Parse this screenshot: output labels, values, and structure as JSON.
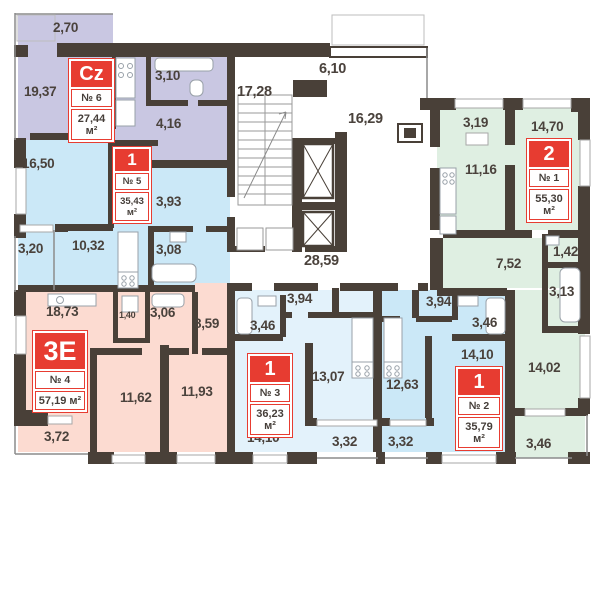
{
  "colors": {
    "wall": "#494038",
    "accent_red": "#e73c31",
    "apt6_fill": "#c9c7e2",
    "apt5_fill": "#cbe8f7",
    "apt4_fill": "#fcdbd1",
    "apt3_fill": "#e3f2fb",
    "apt2_fill": "#cbe8f7",
    "apt1_fill": "#dfefe2"
  },
  "apartments": [
    {
      "key": "apt6",
      "type_label": "Cz",
      "number": "№ 6",
      "area": "27,44 м²",
      "rooms": [
        {
          "name": "balcony",
          "dim": "2,70"
        },
        {
          "name": "living",
          "dim": "19,37"
        },
        {
          "name": "bathroom",
          "dim": "3,10"
        },
        {
          "name": "hall",
          "dim": "4,16"
        }
      ]
    },
    {
      "key": "apt5",
      "type_label": "1",
      "number": "№ 5",
      "area": "35,43 м²",
      "rooms": [
        {
          "name": "living",
          "dim": "16,50"
        },
        {
          "name": "hall",
          "dim": "3,93"
        },
        {
          "name": "balcony",
          "dim": "3,20"
        },
        {
          "name": "kitchen",
          "dim": "10,32"
        },
        {
          "name": "bathroom",
          "dim": "3,08"
        }
      ]
    },
    {
      "key": "apt4",
      "type_label": "3E",
      "number": "№ 4",
      "area": "57,19 м²",
      "rooms": [
        {
          "name": "kitchen-living",
          "dim": "18,73"
        },
        {
          "name": "closet",
          "dim": "1,40"
        },
        {
          "name": "bathroom",
          "dim": "3,06"
        },
        {
          "name": "hall",
          "dim": "8,59"
        },
        {
          "name": "bedroom-1",
          "dim": "11,62"
        },
        {
          "name": "bedroom-2",
          "dim": "11,93"
        },
        {
          "name": "balcony",
          "dim": "3,72"
        }
      ]
    },
    {
      "key": "apt3",
      "type_label": "1",
      "number": "№ 3",
      "area": "36,23 м²",
      "rooms": [
        {
          "name": "hall",
          "dim": "3,94"
        },
        {
          "name": "bathroom",
          "dim": "3,46"
        },
        {
          "name": "kitchen",
          "dim": "13,07"
        },
        {
          "name": "living",
          "dim": "14,10"
        },
        {
          "name": "balcony",
          "dim": "3,32"
        }
      ]
    },
    {
      "key": "apt2",
      "type_label": "1",
      "number": "№ 2",
      "area": "35,79 м²",
      "rooms": [
        {
          "name": "hall",
          "dim": "3,94"
        },
        {
          "name": "bathroom",
          "dim": "3,46"
        },
        {
          "name": "kitchen",
          "dim": "12,63"
        },
        {
          "name": "living",
          "dim": "14,10"
        },
        {
          "name": "balcony",
          "dim": "3,32"
        }
      ]
    },
    {
      "key": "apt1",
      "type_label": "2",
      "number": "№ 1",
      "area": "55,30 м²",
      "rooms": [
        {
          "name": "kitchen-niche",
          "dim": "3,19"
        },
        {
          "name": "living-kitchen",
          "dim": "11,16"
        },
        {
          "name": "bedroom",
          "dim": "14,70"
        },
        {
          "name": "hall",
          "dim": "7,52"
        },
        {
          "name": "storage",
          "dim": "1,42"
        },
        {
          "name": "bathroom",
          "dim": "3,13"
        },
        {
          "name": "room",
          "dim": "14,02"
        },
        {
          "name": "balcony",
          "dim": "3,46"
        }
      ]
    }
  ],
  "common_areas": [
    {
      "name": "stairwell",
      "dim": "17,28"
    },
    {
      "name": "corridor-upper",
      "dim": "6,10"
    },
    {
      "name": "lobby",
      "dim": "16,29"
    },
    {
      "name": "corridor-main",
      "dim": "28,59"
    }
  ]
}
